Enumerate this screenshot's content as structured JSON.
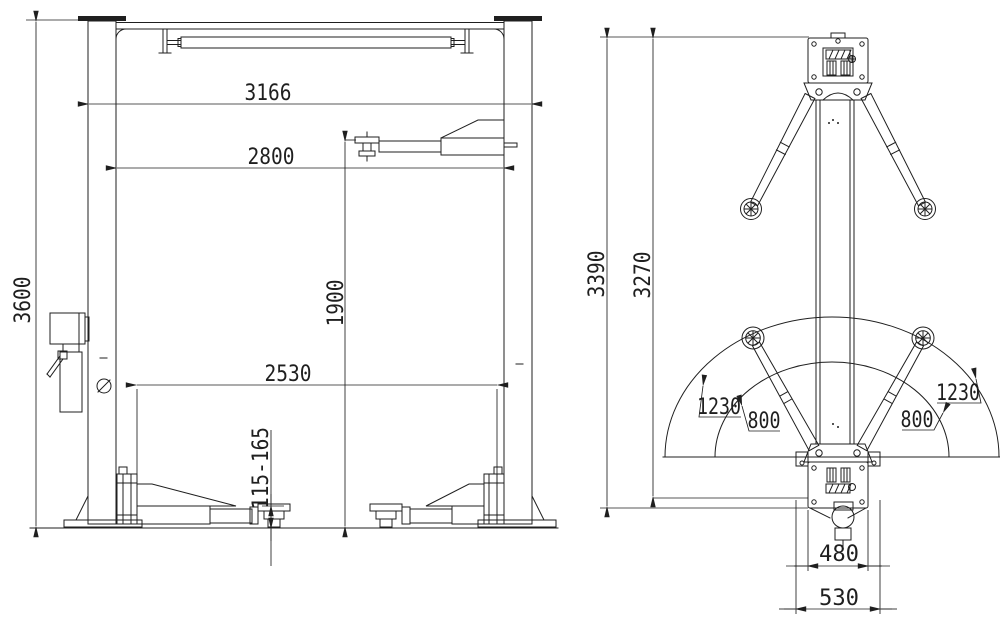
{
  "drawing": {
    "background": "#ffffff",
    "line_color": "#1f1f1f",
    "front": {
      "overall_height": "3600",
      "overall_width": "3166",
      "inner_width": "2800",
      "lift_height": "1900",
      "arm_span": "2530",
      "pad_height_range": "115-165"
    },
    "plan": {
      "total_height": "3390",
      "column_height": "3270",
      "reach_max_left": "1230",
      "reach_max_right": "1230",
      "reach_min_left": "800",
      "reach_min_right": "800",
      "base_width": "480",
      "baseplate_width": "530"
    }
  }
}
